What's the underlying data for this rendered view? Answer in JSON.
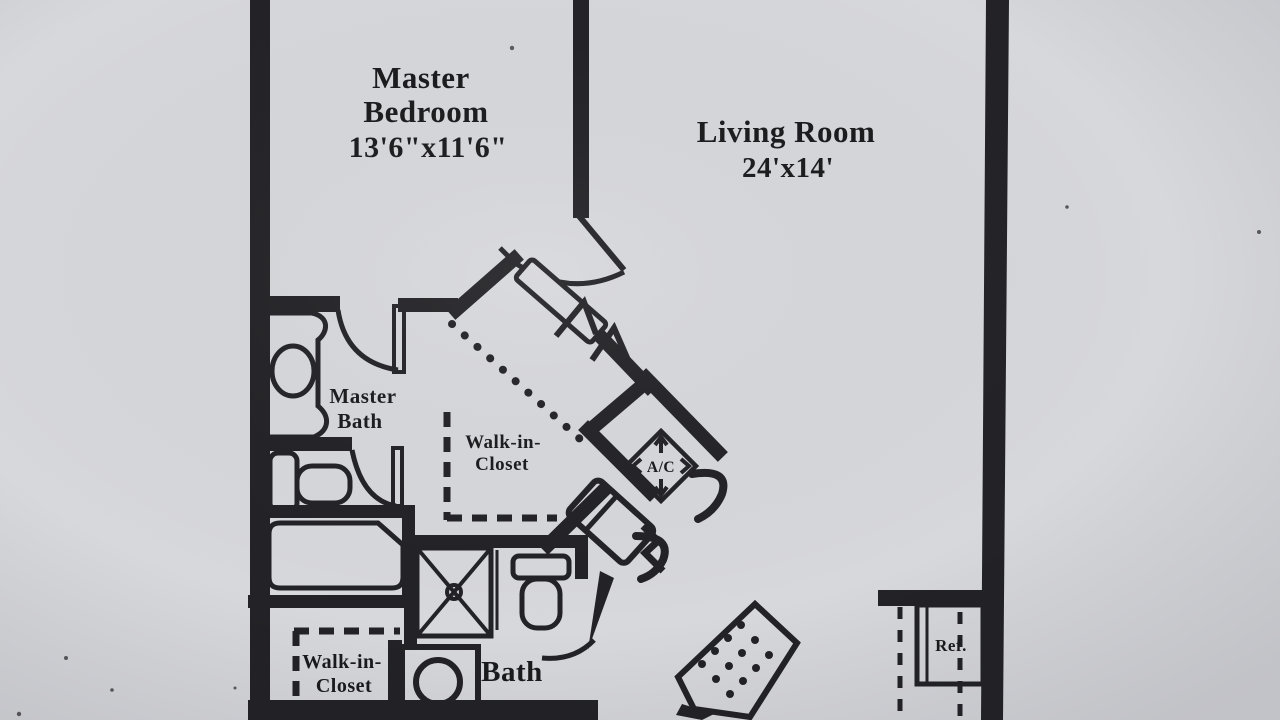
{
  "figure": {
    "kind": "floor-plan photocopy",
    "palette": {
      "paper": "#d7d8dc",
      "ink": "#232327"
    }
  },
  "rooms": {
    "master_bedroom": {
      "line1": "Master",
      "line2": "Bedroom",
      "dimensions": "13'6\"x11'6\""
    },
    "living_room": {
      "line1": "Living Room",
      "dimensions": "24'x14'"
    },
    "master_bath": {
      "line1": "Master",
      "line2": "Bath"
    },
    "walk_in_closet_upper": {
      "line1": "Walk-in-",
      "line2": "Closet"
    },
    "walk_in_closet_lower": {
      "line1": "Walk-in-",
      "line2": "Closet"
    },
    "bath": {
      "line1": "Bath"
    }
  },
  "appliances": {
    "refrigerator": "Ref.",
    "air_conditioner": "A/C"
  }
}
